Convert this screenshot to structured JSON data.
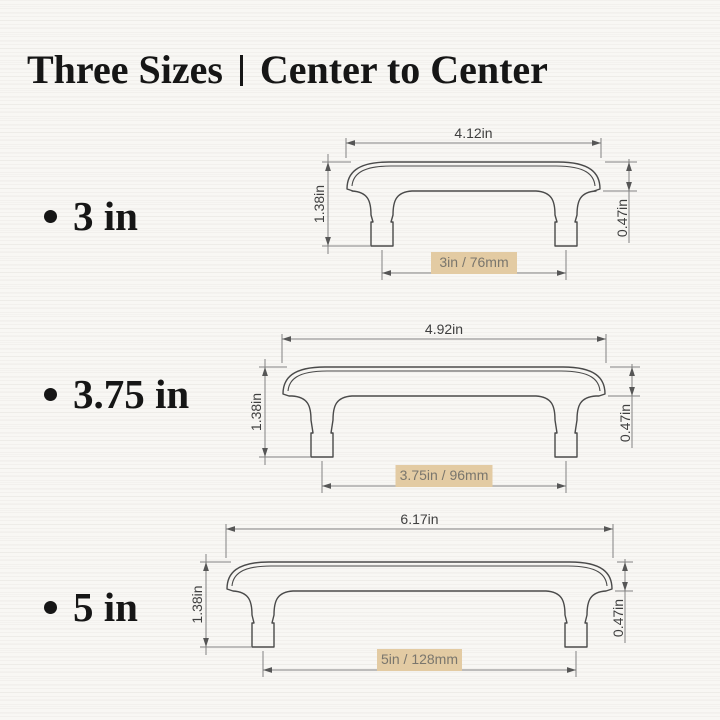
{
  "title": {
    "left": "Three Sizes",
    "right": "Center to Center"
  },
  "colors": {
    "background": "#f8f7f4",
    "heading_text": "#161616",
    "handle_outline": "#4a4a4a",
    "dimension_line": "#828282",
    "arrowhead": "#565656",
    "dimension_text": "#3f3f3f",
    "highlight_box": "#e3cba3",
    "highlight_text": "#7a766d"
  },
  "sizes": [
    {
      "bullet_label": "3 in",
      "overall_length_label": "4.12in",
      "height_label": "1.38in",
      "thickness_label": "0.47in",
      "center_to_center_label": "3in / 76mm",
      "overall_length_in": 4.12,
      "height_in": 1.38,
      "thickness_in": 0.47,
      "center_to_center_in": 3,
      "center_to_center_mm": 76
    },
    {
      "bullet_label": "3.75 in",
      "overall_length_label": "4.92in",
      "height_label": "1.38in",
      "thickness_label": "0.47in",
      "center_to_center_label": "3.75in / 96mm",
      "overall_length_in": 4.92,
      "height_in": 1.38,
      "thickness_in": 0.47,
      "center_to_center_in": 3.75,
      "center_to_center_mm": 96
    },
    {
      "bullet_label": "5 in",
      "overall_length_label": "6.17in",
      "height_label": "1.38in",
      "thickness_label": "0.47in",
      "center_to_center_label": "5in / 128mm",
      "overall_length_in": 6.17,
      "height_in": 1.38,
      "thickness_in": 0.47,
      "center_to_center_in": 5,
      "center_to_center_mm": 128
    }
  ]
}
